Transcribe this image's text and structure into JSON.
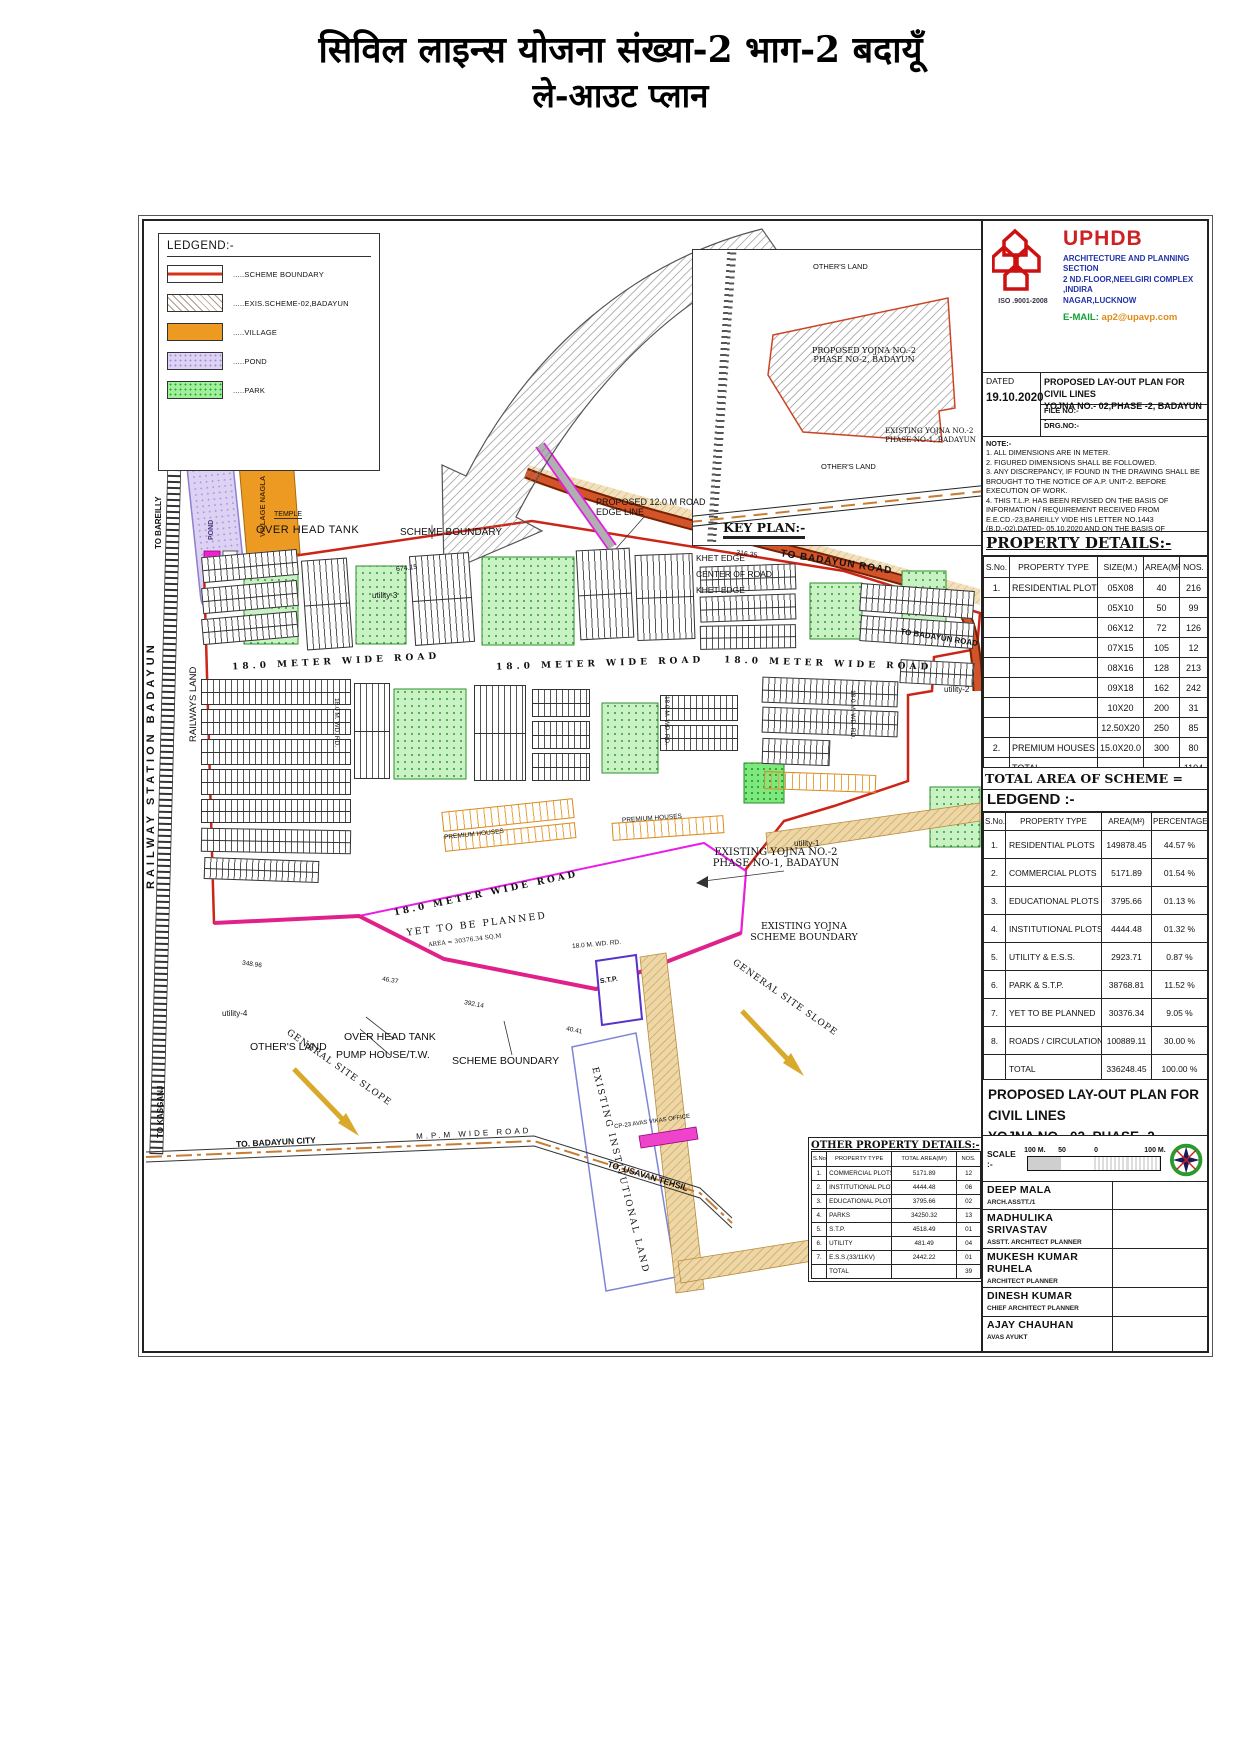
{
  "page_title": {
    "line1": "सिविल लाइन्स योजना संख्या-2 भाग-2 बदायूँ",
    "line2": "ले-आउट प्लान"
  },
  "legend_box": {
    "title": "LEDGEND:-",
    "items": [
      {
        "swatch": "scheme-boundary",
        "label": ".....SCHEME BOUNDARY"
      },
      {
        "swatch": "exis-scheme",
        "label": ".....EXIS.SCHEME-02,BADAYUN"
      },
      {
        "swatch": "village",
        "label": ".....VILLAGE"
      },
      {
        "swatch": "pond",
        "label": ".....POND"
      },
      {
        "swatch": "park",
        "label": ".....PARK"
      }
    ]
  },
  "key_plan": {
    "title": "KEY PLAN:-",
    "others_land_top": "OTHER'S LAND",
    "others_land_bottom": "OTHER'S LAND",
    "proposed_l1": "PROPOSED YOJNA NO.-2",
    "proposed_l2": "PHASE NO-2, BADAYUN",
    "existing_l1": "EXISTING YOJNA NO.-2",
    "existing_l2": "PHASE NO-1, BADAYUN"
  },
  "title_block": {
    "org": "UPHDB",
    "org_line1": "ARCHITECTURE AND PLANNING SECTION",
    "org_line2": "2 ND.FLOOR,NEELGIRI COMPLEX ,INDIRA",
    "org_line3": "NAGAR,LUCKNOW",
    "iso": "ISO .9001-2008",
    "email_label": "E-MAIL:",
    "email": "ap2@upavp.com",
    "dated_label": "DATED",
    "dated": "19.10.2020",
    "title_line1": "PROPOSED LAY-OUT PLAN FOR CIVIL LINES",
    "title_line2": "YOJNA NO.- 02,PHASE -2, BADAYUN .",
    "file_no": "FILE NO:-",
    "drg_no": "DRG.NO:-",
    "note_title": "NOTE:-",
    "notes": [
      "1. ALL DIMENSIONS ARE IN METER.",
      "2. FIGURED DIMENSIONS SHALL BE FOLLOWED.",
      "3. ANY DISCREPANCY, IF FOUND IN THE DRAWING SHALL BE BROUGHT TO THE NOTICE OF A.P. UNIT-2. BEFORE EXECUTION OF WORK.",
      "4. THIS T.L.P. HAS BEEN REVISED ON THE BASIS OF INFORMATION / REQUIREMENT RECEIVED FROM E.E.CD.-23,BAREILLY VIDE HIS LETTER NO.1443 (B.D.-02),DATED- 05.10.2020 AND ON THE BASIS OF INFORMATION RECEIVED ON WHATSUP FROM E.E.CD.-C.U. RUHELKHAND-04 ON DTD.19.10.2020."
    ]
  },
  "property_details": {
    "title": "PROPERTY DETAILS:-",
    "headers": [
      "S.No.",
      "PROPERTY TYPE",
      "SIZE(M.)",
      "AREA(M²)",
      "NOS."
    ],
    "rows": [
      [
        "1.",
        "RESIDENTIAL PLOTS",
        "05X08",
        "40",
        "216"
      ],
      [
        "",
        "",
        "05X10",
        "50",
        "99"
      ],
      [
        "",
        "",
        "06X12",
        "72",
        "126"
      ],
      [
        "",
        "",
        "07X15",
        "105",
        "12"
      ],
      [
        "",
        "",
        "08X16",
        "128",
        "213"
      ],
      [
        "",
        "",
        "09X18",
        "162",
        "242"
      ],
      [
        "",
        "",
        "10X20",
        "200",
        "31"
      ],
      [
        "",
        "",
        "12.50X20",
        "250",
        "85"
      ],
      [
        "2.",
        "PREMIUM HOUSES",
        "15.0X20.0",
        "300",
        "80"
      ],
      [
        "",
        "TOTAL",
        "",
        "",
        "1104"
      ]
    ]
  },
  "total_area_line": "TOTAL AREA OF SCHEME = 336248.45 SQ.MT",
  "ledgend_table": {
    "title": "LEDGEND :-",
    "headers": [
      "S.No.",
      "PROPERTY TYPE",
      "AREA(M²)",
      "PERCENTAGE"
    ],
    "rows": [
      [
        "1.",
        "RESIDENTIAL PLOTS",
        "149878.45",
        "44.57 %"
      ],
      [
        "2.",
        "COMMERCIAL PLOTS",
        "5171.89",
        "01.54 %"
      ],
      [
        "3.",
        "EDUCATIONAL PLOTS",
        "3795.66",
        "01.13 %"
      ],
      [
        "4.",
        "INSTITUTIONAL PLOTS",
        "4444.48",
        "01.32 %"
      ],
      [
        "5.",
        "UTILITY & E.S.S.",
        "2923.71",
        "0.87 %"
      ],
      [
        "6.",
        "PARK & S.T.P.",
        "38768.81",
        "11.52 %"
      ],
      [
        "7.",
        "YET TO BE PLANNED",
        "30376.34",
        "9.05 %"
      ],
      [
        "8.",
        "ROADS / CIRCULATION",
        "100889.11",
        "30.00 %"
      ],
      [
        "",
        "TOTAL",
        "336248.45",
        "100.00 %"
      ]
    ]
  },
  "drawing_caption": {
    "line1": "PROPOSED LAY-OUT PLAN FOR CIVIL LINES",
    "line2": "YOJNA NO.- 02, PHASE -2, BADAYUN ."
  },
  "scale_bar": {
    "label": "SCALE :-",
    "left": "100 M.",
    "mid": "50",
    "zero": "0",
    "right": "100 M."
  },
  "signatories": [
    {
      "name": "DEEP MALA",
      "title": "ARCH.ASSTT./1"
    },
    {
      "name": "MADHULIKA SRIVASTAV",
      "title": "ASSTT. ARCHITECT PLANNER"
    },
    {
      "name": "MUKESH KUMAR RUHELA",
      "title": "ARCHITECT PLANNER"
    },
    {
      "name": "DINESH KUMAR",
      "title": "CHIEF ARCHITECT PLANNER"
    },
    {
      "name": "AJAY CHAUHAN",
      "title": "AVAS AYUKT"
    }
  ],
  "other_property_details": {
    "title": "OTHER PROPERTY DETAILS:-",
    "headers": [
      "S.No.",
      "PROPERTY TYPE",
      "TOTAL AREA(M²)",
      "NOS."
    ],
    "rows": [
      [
        "1.",
        "COMMERCIAL PLOTS",
        "5171.89",
        "12"
      ],
      [
        "2.",
        "INSTITUTIONAL PLOTS",
        "4444.48",
        "06"
      ],
      [
        "3.",
        "EDUCATIONAL PLOTS",
        "3795.66",
        "02"
      ],
      [
        "4.",
        "PARKS",
        "34250.32",
        "13"
      ],
      [
        "5.",
        "S.T.P.",
        "4518.49",
        "01"
      ],
      [
        "6.",
        "UTILITY",
        "481.49",
        "04"
      ],
      [
        "7.",
        "E.S.S.(33/11KV)",
        "2442.22",
        "01"
      ],
      [
        "",
        "TOTAL",
        "",
        "39"
      ]
    ]
  },
  "map_labels": {
    "over_head_tank": "OVER HEAD TANK",
    "scheme_boundary": "SCHEME BOUNDARY",
    "proposed_road_l1": "PROPOSED 12.0 M ROAD",
    "proposed_road_l2": "EDGE LINE",
    "khet_edge": "KHET EDGE",
    "center_of_road": "CENTER OF ROAD",
    "khet_edge2": "KHET EDGE",
    "to_badayun_road": "TO BADAYUN ROAD",
    "temple": "TEMPLE",
    "pond": "POND",
    "village": "VILLAGE NAGLA",
    "to_bareilly": "TO BAREILLY",
    "railway_station": "RAILWAY STATION BADAYUN",
    "railways_land": "RAILWAYS LAND",
    "to_kasganj": "TO KASGANJ",
    "road_18m": "18.0 METER WIDE ROAD",
    "road_18m_short": "18.0 M. WD. RD.",
    "premium_houses": "PREMIUM HOUSES",
    "yet_to_be_planned": "YET TO BE PLANNED",
    "ytbp_area": "AREA = 30376.34 SQ.M",
    "stp": "S.T.P.",
    "over_head_tank2": "OVER HEAD TANK",
    "pump_house": "PUMP HOUSE/T.W.",
    "others_land": "OTHER'S LAND",
    "scheme_boundary2": "SCHEME BOUNDARY",
    "existing_yojna_l1": "EXISTING YOJNA NO.-2",
    "existing_yojna_l2": "PHASE NO-1, BADAYUN",
    "existing_sb_l1": "EXISTING YOJNA",
    "existing_sb_l2": "SCHEME BOUNDARY",
    "general_site_slope": "GENERAL SITE SLOPE",
    "existing_institutional": "EXISTING INSTITUTIONAL LAND",
    "to_badayun_city": "TO. BADAYUN CITY",
    "wide_road": "M.P.M WIDE ROAD",
    "to_usavan": "TO, USAVAN TEHSIL",
    "cp23": "CP-23 AVAS VIKAS OFFICE",
    "utility1": "utility-1",
    "utility2": "utility-2",
    "utility3": "utility-3",
    "utility4": "utility-4",
    "dims": [
      "674.15",
      "316.35",
      "348.96",
      "46.37",
      "392.14",
      "40.41"
    ]
  }
}
